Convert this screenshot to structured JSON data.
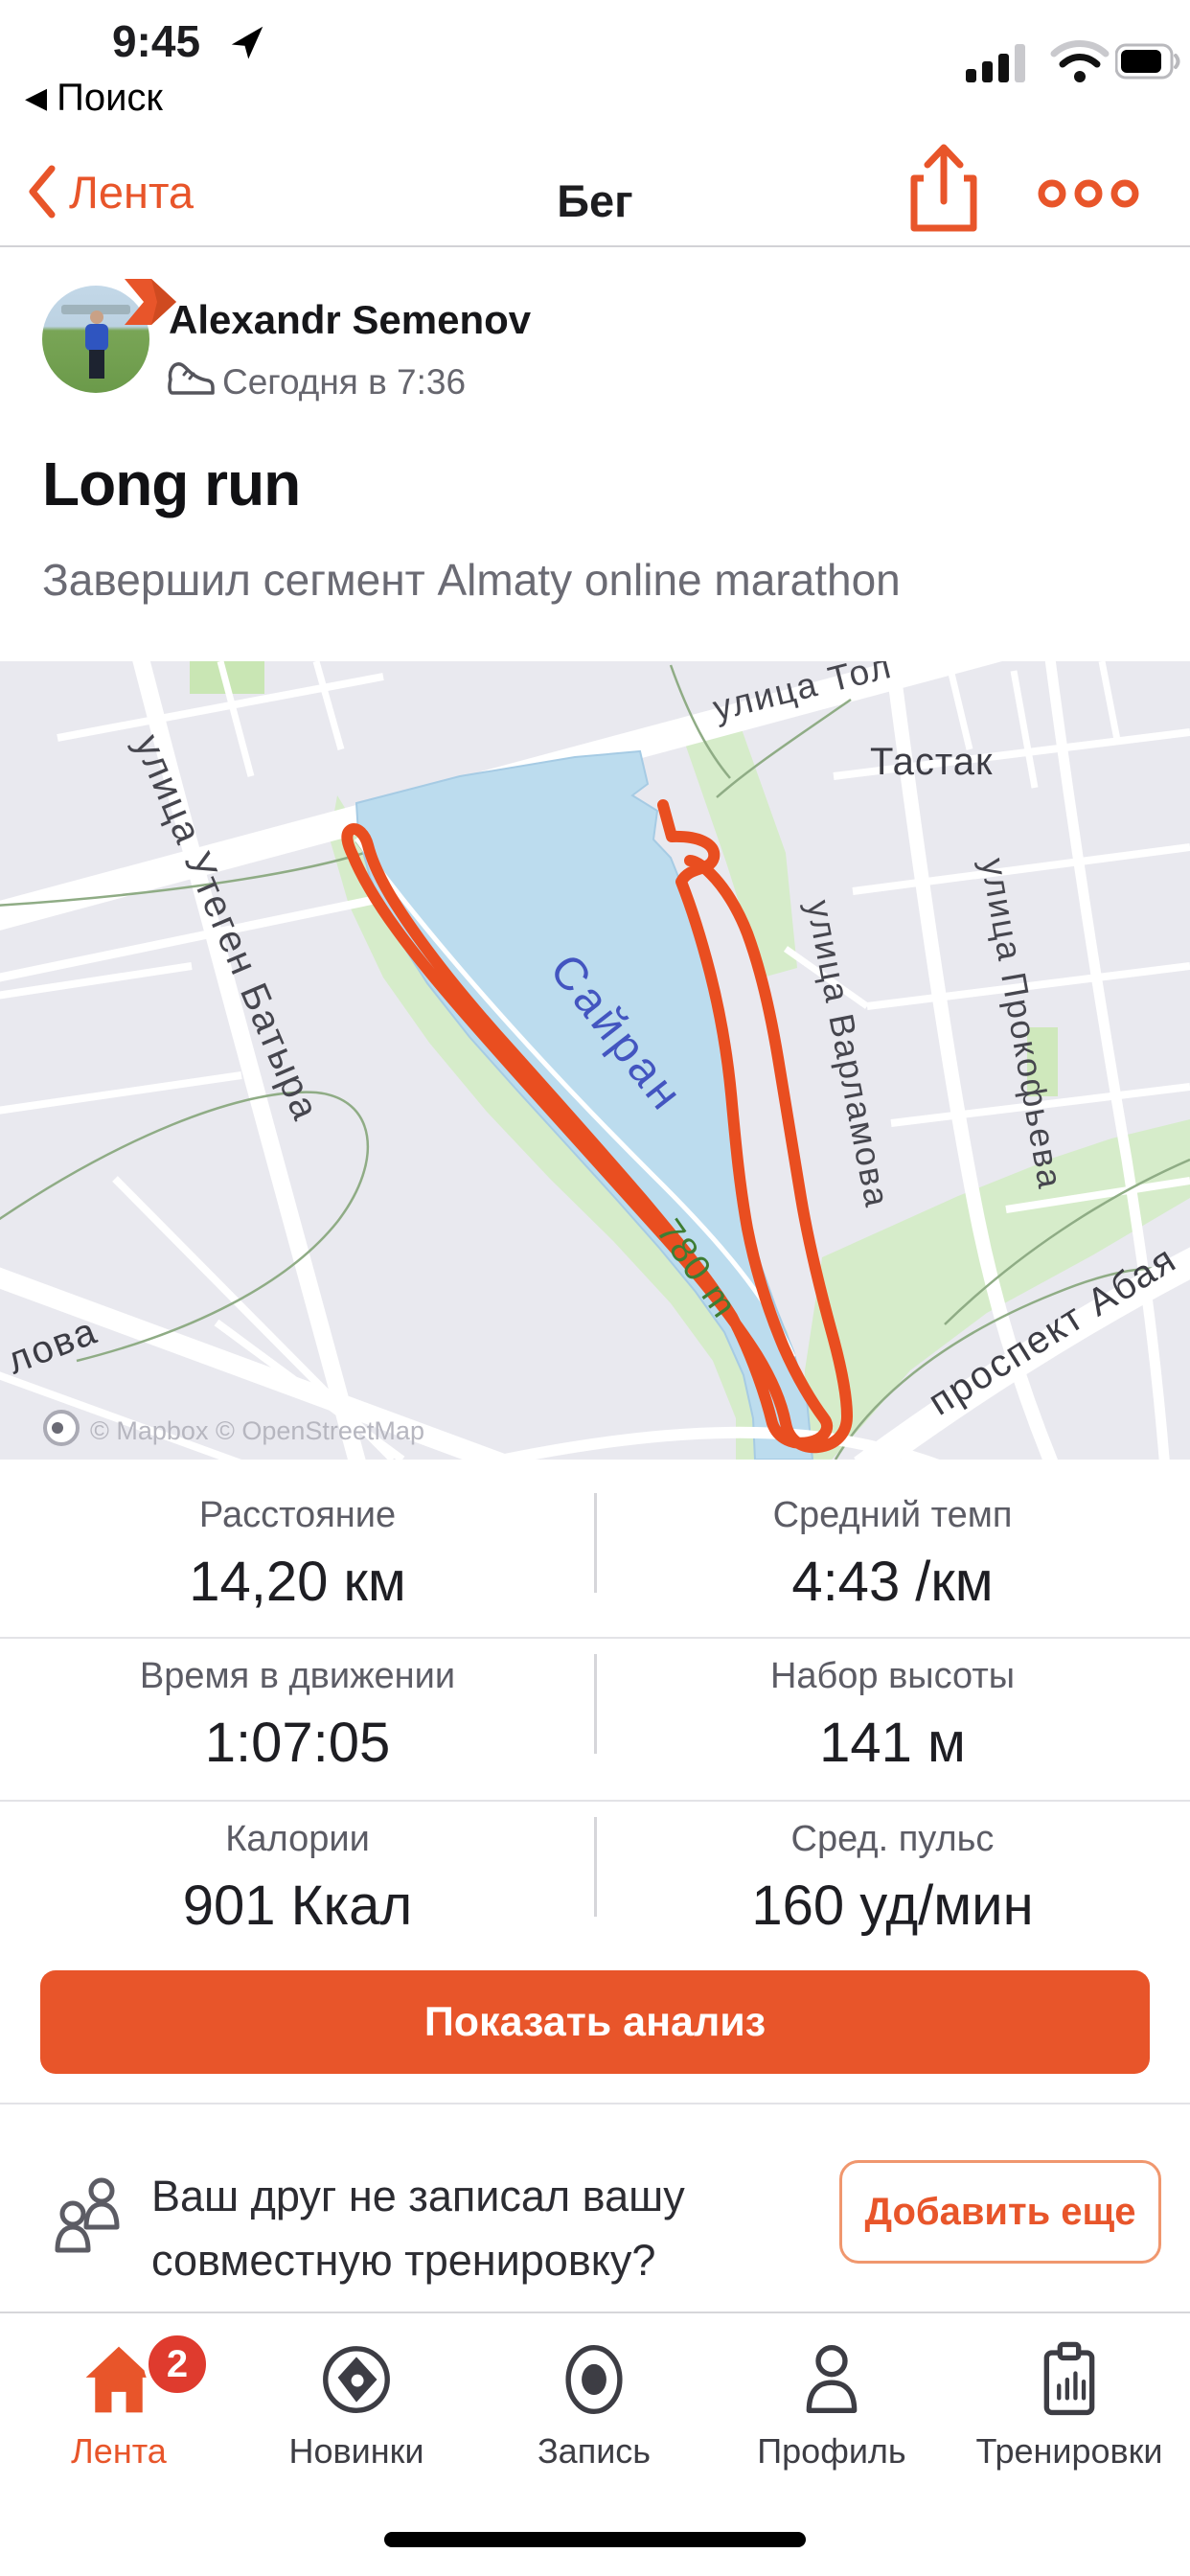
{
  "colors": {
    "accent": "#e8552a",
    "route": "#e94e20",
    "lake": "#bcdcee",
    "park": "#d6ecca",
    "map_bg": "#e9e9ef",
    "badge_red": "#df3b2e"
  },
  "status_bar": {
    "time": "9:45",
    "back_glyph": "◀",
    "back_app": "Поиск"
  },
  "nav": {
    "back_label": "Лента",
    "title": "Бег"
  },
  "post": {
    "author": "Alexandr Semenov",
    "timestamp": "Сегодня в 7:36",
    "title": "Long run",
    "subtitle": "Завершил сегмент Almaty online marathon"
  },
  "map": {
    "labels": {
      "street_top": "улица Тол",
      "district": "Тастак",
      "street_west": "улица Утеген Батыра",
      "lake": "Сайран",
      "street_varlamova": "улица Варламова",
      "street_prokofieva": "улица Прокофьева",
      "distance_marker": "780 m",
      "avenue_abaya": "проспект Абая",
      "street_partial": "лова",
      "attribution": "© Mapbox © OpenStreetMap"
    }
  },
  "stats": {
    "rows": [
      [
        {
          "label": "Расстояние",
          "value": "14,20 км"
        },
        {
          "label": "Средний темп",
          "value": "4:43 /км"
        }
      ],
      [
        {
          "label": "Время в движении",
          "value": "1:07:05"
        },
        {
          "label": "Набор высоты",
          "value": "141 м"
        }
      ],
      [
        {
          "label": "Калории",
          "value": "901 Ккал"
        },
        {
          "label": "Сред. пульс",
          "value": "160 уд/мин"
        }
      ]
    ]
  },
  "analyze_button": "Показать анализ",
  "friend_prompt": {
    "line1": "Ваш друг не записал вашу",
    "line2": "совместную тренировку?",
    "button": "Добавить еще"
  },
  "tab_bar": {
    "items": [
      {
        "label": "Лента",
        "badge": "2"
      },
      {
        "label": "Новинки"
      },
      {
        "label": "Запись"
      },
      {
        "label": "Профиль"
      },
      {
        "label": "Тренировки"
      }
    ]
  }
}
